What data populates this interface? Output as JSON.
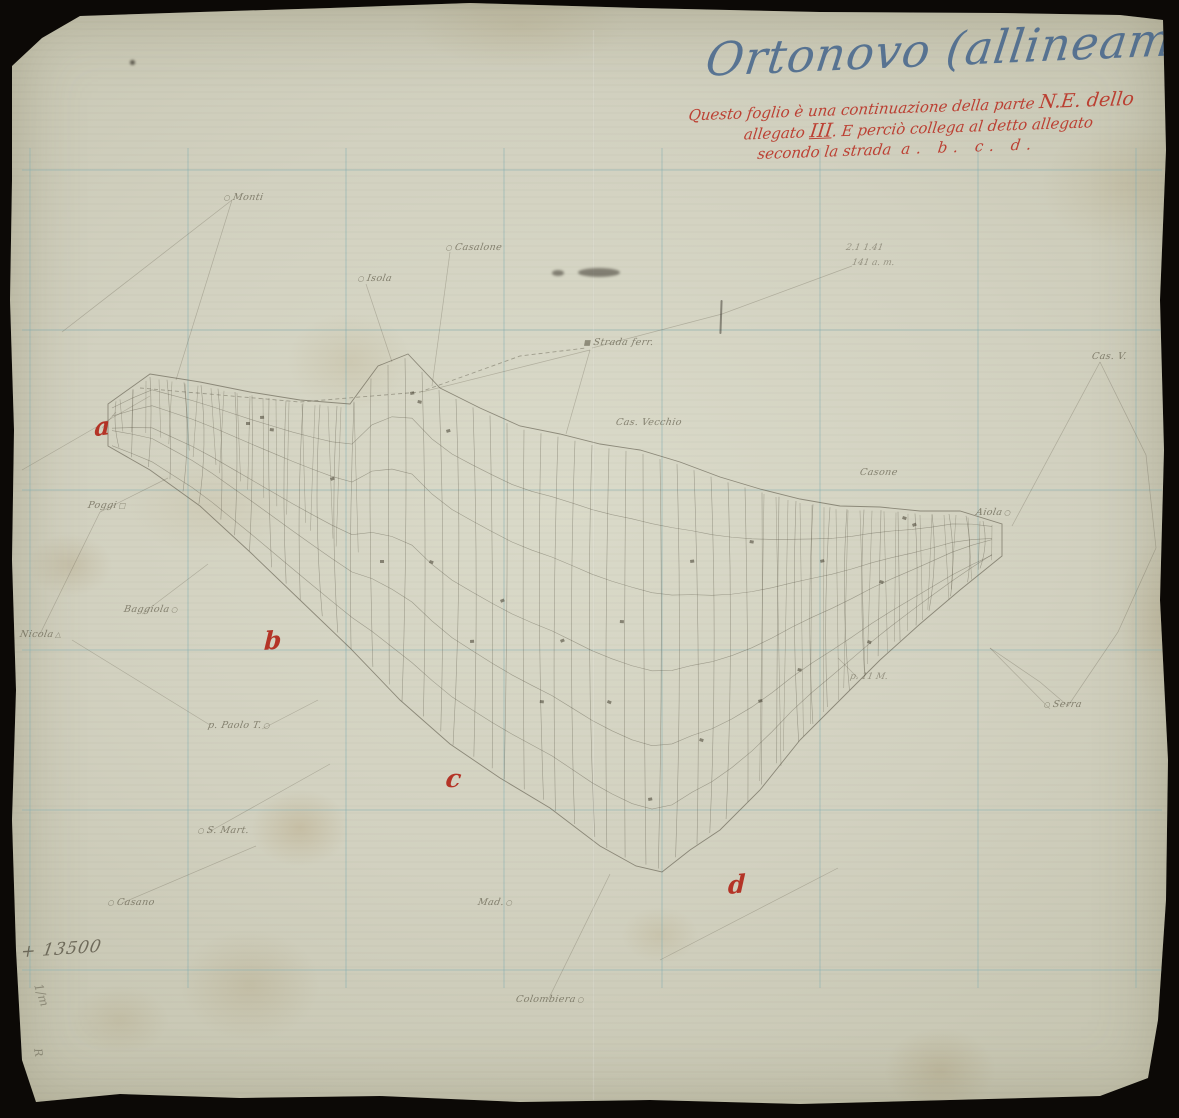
{
  "document": {
    "title": "Ortonovo (allineamenti)",
    "note": {
      "line1a": "Questo foglio è una continuazione della parte",
      "line1b": "N.E. dello",
      "line2a": "allegato ",
      "line2b": "III",
      "line2c": ". E perciò collega al detto allegato",
      "line3a": "secondo la strada",
      "line3b": "a. b. c. d."
    },
    "pencil_note": "y + 13500",
    "pencil_marks": [
      "1/m",
      "R"
    ]
  },
  "map": {
    "reference_letters": [
      {
        "label": "a",
        "x": 94,
        "y": 412
      },
      {
        "label": "b",
        "x": 264,
        "y": 626
      },
      {
        "label": "c",
        "x": 446,
        "y": 764
      },
      {
        "label": "d",
        "x": 728,
        "y": 870
      }
    ],
    "place_labels": [
      {
        "text": "Monti",
        "marker": "circle",
        "marker_first": true,
        "x": 222,
        "y": 192
      },
      {
        "text": "Casalone",
        "marker": "circle",
        "marker_first": true,
        "x": 444,
        "y": 242
      },
      {
        "text": "Isola",
        "marker": "circle",
        "marker_first": true,
        "x": 356,
        "y": 273
      },
      {
        "text": "Strada ferr.",
        "marker": "square",
        "marker_first": true,
        "x": 582,
        "y": 337
      },
      {
        "text": "Cas. Vecchio",
        "marker": null,
        "marker_first": false,
        "x": 616,
        "y": 417
      },
      {
        "text": "Casone",
        "marker": null,
        "marker_first": false,
        "x": 860,
        "y": 467
      },
      {
        "text": "Aiola",
        "marker": "circle",
        "marker_first": false,
        "x": 976,
        "y": 507
      },
      {
        "text": "Cas. V.",
        "marker": null,
        "marker_first": false,
        "x": 1092,
        "y": 351
      },
      {
        "text": "Nicola",
        "marker": "triangle",
        "marker_first": false,
        "x": 20,
        "y": 629
      },
      {
        "text": "Poggi",
        "marker": "square-open",
        "marker_first": false,
        "x": 88,
        "y": 500
      },
      {
        "text": "Baggiola",
        "marker": "circle",
        "marker_first": false,
        "x": 124,
        "y": 604
      },
      {
        "text": "p. Paolo T.",
        "marker": "circle",
        "marker_first": false,
        "x": 208,
        "y": 720
      },
      {
        "text": "S. Mart.",
        "marker": "circle",
        "marker_first": true,
        "x": 196,
        "y": 825
      },
      {
        "text": "Casano",
        "marker": "circle",
        "marker_first": true,
        "x": 106,
        "y": 897
      },
      {
        "text": "Serra",
        "marker": "circle",
        "marker_first": true,
        "x": 1042,
        "y": 699
      },
      {
        "text": "Colombiera",
        "marker": "circle",
        "marker_first": false,
        "x": 516,
        "y": 994
      },
      {
        "text": "Mad.",
        "marker": "circle",
        "marker_first": false,
        "x": 478,
        "y": 897
      }
    ],
    "pencil_annotations": [
      {
        "text": "2.1  1.41",
        "x": 846,
        "y": 243
      },
      {
        "text": "141 a. m.",
        "x": 852,
        "y": 258
      },
      {
        "text": "p. 11 M.",
        "x": 850,
        "y": 672
      }
    ]
  },
  "colors": {
    "background": "#0c0906",
    "paper": "#d2d1c0",
    "grid_blue": "#84afb2",
    "red_ink": "#b2261a",
    "blue_ink": "#3e608a",
    "pencil": "#5f5a48"
  }
}
